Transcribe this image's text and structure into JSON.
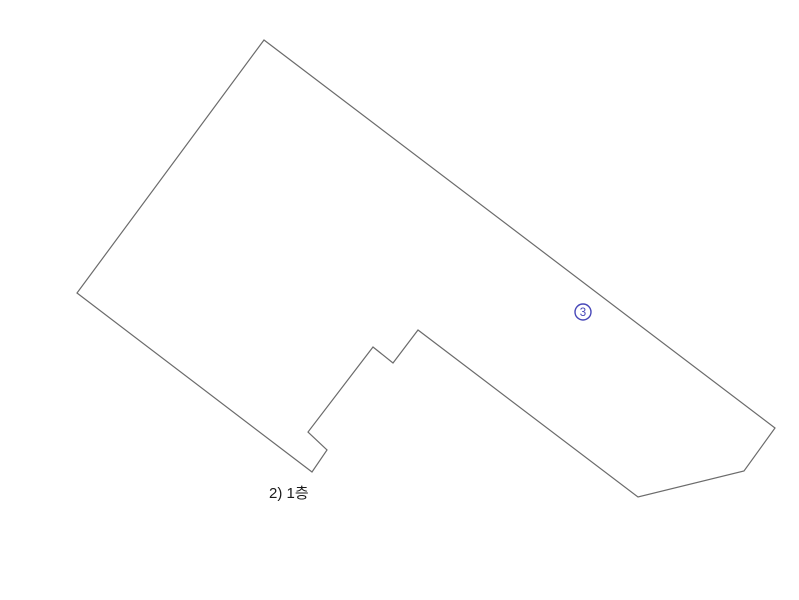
{
  "canvas": {
    "width": 799,
    "height": 600,
    "background": "#ffffff"
  },
  "drawing": {
    "outline": {
      "description": "floor-plan-boundary",
      "points": [
        [
          264,
          40
        ],
        [
          775,
          428
        ],
        [
          744,
          471
        ],
        [
          638,
          497
        ],
        [
          418,
          330
        ],
        [
          393,
          363
        ],
        [
          373,
          347
        ],
        [
          308,
          432
        ],
        [
          327,
          450
        ],
        [
          312,
          472
        ],
        [
          77,
          293
        ]
      ],
      "stroke": "#6b6b6b",
      "stroke_width": 1.2,
      "fill": "none"
    },
    "marker": {
      "label": "3",
      "unicode": "③",
      "cx": 583,
      "cy": 312,
      "radius": 8,
      "stroke_width": 1.4,
      "color": "#4747b8",
      "font_size": 11.5
    },
    "caption": {
      "text": "2) 1층",
      "x": 269,
      "y": 486,
      "color": "#1a1a1a",
      "font_size": 15
    }
  }
}
